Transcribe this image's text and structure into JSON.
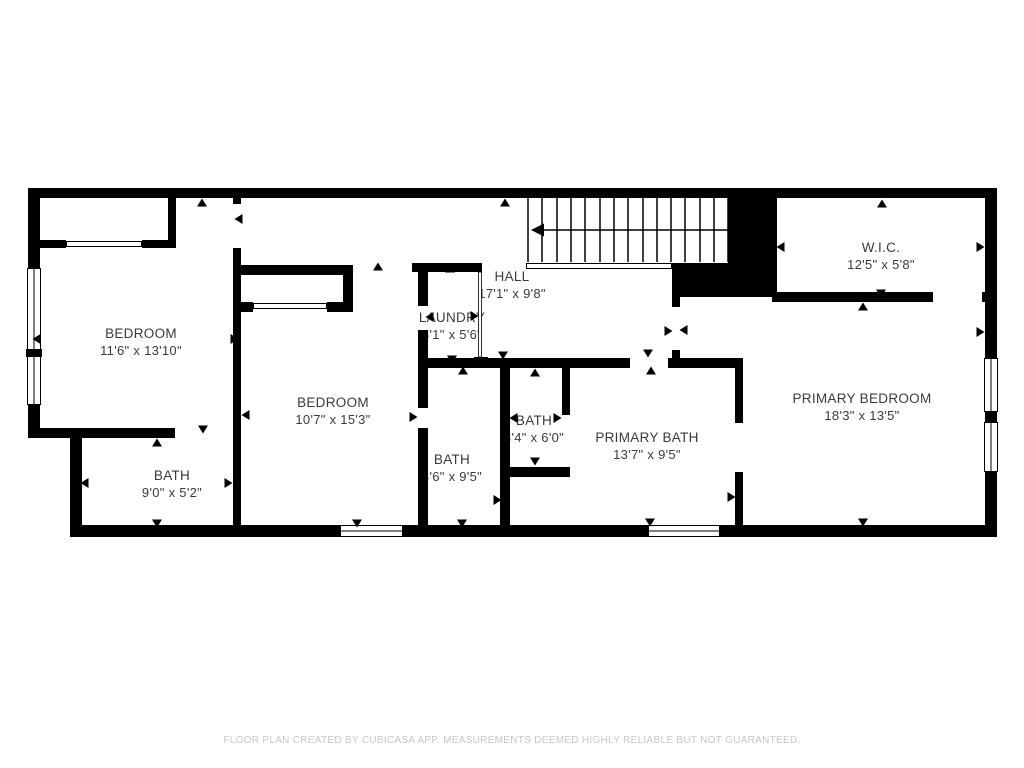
{
  "rooms": [
    {
      "name": "BEDROOM",
      "dims": "11'6\" x 13'10\""
    },
    {
      "name": "BATH",
      "dims": "9'0\" x 5'2\""
    },
    {
      "name": "BEDROOM",
      "dims": "10'7\" x 15'3\""
    },
    {
      "name": "LAUNDRY",
      "dims": "3'1\" x 5'6\""
    },
    {
      "name": "HALL",
      "dims": "17'1\" x 9'8\""
    },
    {
      "name": "BATH",
      "dims": "4'6\" x 9'5\""
    },
    {
      "name": "BATH",
      "dims": "3'4\" x 6'0\""
    },
    {
      "name": "PRIMARY BATH",
      "dims": "13'7\" x 9'5\""
    },
    {
      "name": "W.I.C.",
      "dims": "12'5\" x 5'8\""
    },
    {
      "name": "PRIMARY BEDROOM",
      "dims": "18'3\" x 13'5\""
    }
  ],
  "footer": {
    "disclaimer": "FLOOR PLAN CREATED BY CUBICASA APP. MEASUREMENTS DEEMED HIGHLY RELIABLE BUT NOT GUARANTEED."
  }
}
